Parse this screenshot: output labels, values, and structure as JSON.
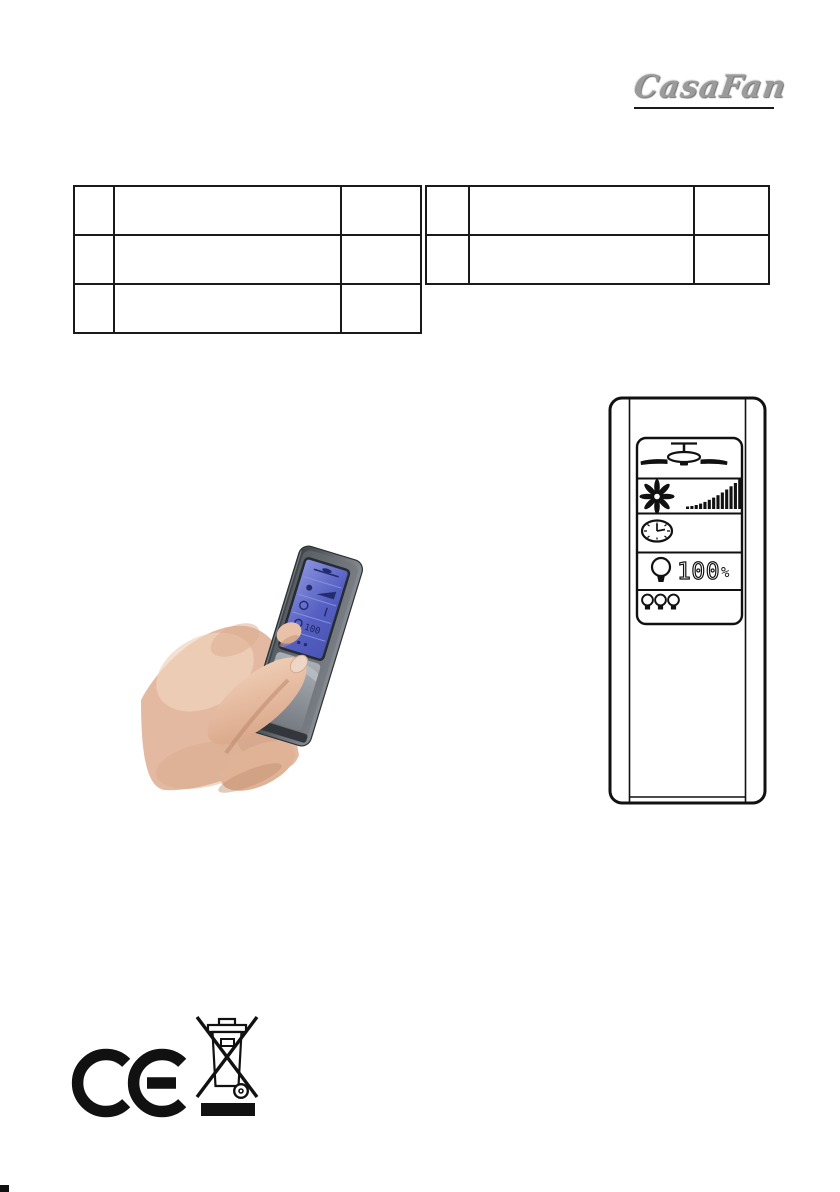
{
  "page": {
    "background": "#ffffff",
    "width_px": 840,
    "height_px": 1192
  },
  "logo": {
    "text": "CasaFan",
    "color": "#9b9b9b",
    "underline_color": "#1a1a1a"
  },
  "tables": {
    "border_color": "#1a1a1a",
    "left": {
      "cells": [
        [
          "",
          "",
          ""
        ],
        [
          "",
          "",
          ""
        ],
        [
          "",
          "",
          ""
        ]
      ]
    },
    "right": {
      "cells": [
        [
          "",
          "",
          ""
        ],
        [
          "",
          "",
          ""
        ]
      ]
    }
  },
  "photo": {
    "subject": "hand-holding-lcd-remote",
    "screen_color": "#5560c2",
    "body_color": "#60666c",
    "skin_color": "#e3baa1",
    "screen_value": "100"
  },
  "remote_diagram": {
    "outline_color": "#111111",
    "display_rows": [
      {
        "icon": "ceiling-fan-icon"
      },
      {
        "icon": "fan-blades-icon",
        "indicator": "speed-ramp-bars"
      },
      {
        "icon": "clock-icon"
      },
      {
        "icon": "bulb-icon",
        "value": "100",
        "unit": "%"
      },
      {
        "icon": "three-bulbs-icon"
      }
    ]
  },
  "footer": {
    "ce_mark": "CE",
    "weee_symbol": "crossed-out-wheeled-bin"
  }
}
